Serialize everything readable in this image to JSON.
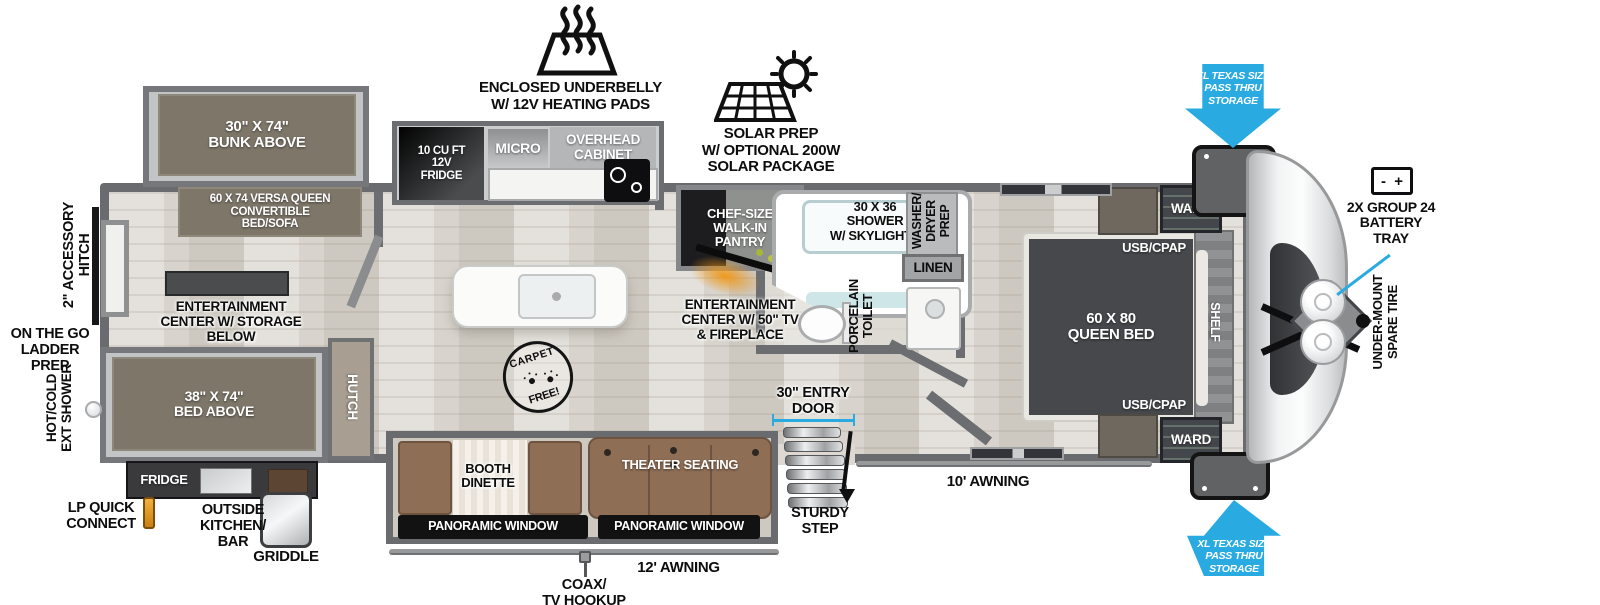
{
  "title": "Travel trailer floor plan",
  "colors": {
    "accent_blue": "#29abe2",
    "wall_gray": "#6b6d70",
    "furniture_taupe": "#7d7669",
    "sofa_brown": "#8e6e55",
    "fireplace_orange": "#f09614",
    "lp_orange": "#e0941e"
  },
  "icons": {
    "heating_pads_icon": "trapezoid with rising heat waves",
    "solar_panel_icon": "tilted solar grid with sun",
    "battery_icon": "rectangle with - and + terminals",
    "pass_thru_arrow_down_icon": "blue down arrow",
    "pass_thru_arrow_up_icon": "blue up arrow",
    "door_width_line_icon": "blue measurement line",
    "entry_steps_icon": "stacked metal treads",
    "propane_tanks_icon": "two round tanks on A-frame",
    "shower_knob_icon": "round knob",
    "lp_connector_icon": "orange quick-connect valve",
    "coax_connector_icon": "cable connector",
    "griddle_icon": "silver griddle",
    "carpet_free_stamp_icon": "round stamp with paw prints",
    "cooktop_icon": "two burner cooktop",
    "sink_icon": "island sink"
  },
  "labels": {
    "underbelly": "ENCLOSED UNDERBELLY\nW/ 12V HEATING PADS",
    "solar": "SOLAR PREP\nW/ OPTIONAL 200W\nSOLAR PACKAGE",
    "bunk": "30\" X 74\"\nBUNK ABOVE",
    "versa_queen": "60 X 74 VERSA QUEEN\nCONVERTIBLE\nBED/SOFA",
    "ent_storage": "ENTERTAINMENT\nCENTER W/ STORAGE\nBELOW",
    "bed38": "38\" X 74\"\nBED ABOVE",
    "hutch": "HUTCH",
    "fridge12": "10 CU FT\n12V\nFRIDGE",
    "micro": "MICRO",
    "overhead": "OVERHEAD\nCABINET",
    "pantry": "CHEF-SIZE\nWALK-IN\nPANTRY",
    "ent_tv": "ENTERTAINMENT\nCENTER W/ 50\" TV\n& FIREPLACE",
    "shower": "30 X 36\nSHOWER\nW/ SKYLIGHTS",
    "washer": "WASHER/\nDRYER\nPREP",
    "linen": "LINEN",
    "toilet": "PORCELAIN\nTOILET",
    "queen": "60 X  80\nQUEEN BED",
    "usb": "USB/CPAP",
    "ward": "WARD",
    "shelf": "SHELF",
    "pass_thru": "XL TEXAS SIZE\nPASS THRU\nSTORAGE",
    "battery": "2X GROUP 24\nBATTERY\nTRAY",
    "battery_minus": "-",
    "battery_plus": "+",
    "spare": "UNDER-MOUNT\nSPARE TIRE",
    "acc_hitch": "2\" ACCESSORY\nHITCH",
    "ladder": "ON THE GO\nLADDER PREP",
    "ext_shower": "HOT/COLD\nEXT SHOWER",
    "lp": "LP QUICK\nCONNECT",
    "out_kitchen": "OUTSIDE\nKITCHEN/\nBAR",
    "griddle": "GRIDDLE",
    "out_fridge": "FRIDGE",
    "booth": "BOOTH\nDINETTE",
    "theater": "THEATER SEATING",
    "pano": "PANORAMIC WINDOW",
    "door30": "30\" ENTRY\nDOOR",
    "step": "STURDY\nSTEP",
    "awning12": "12' AWNING",
    "awning10": "10' AWNING",
    "coax": "COAX/\nTV HOOKUP",
    "carpet1": "CARPET",
    "carpet2": "FREE!"
  }
}
